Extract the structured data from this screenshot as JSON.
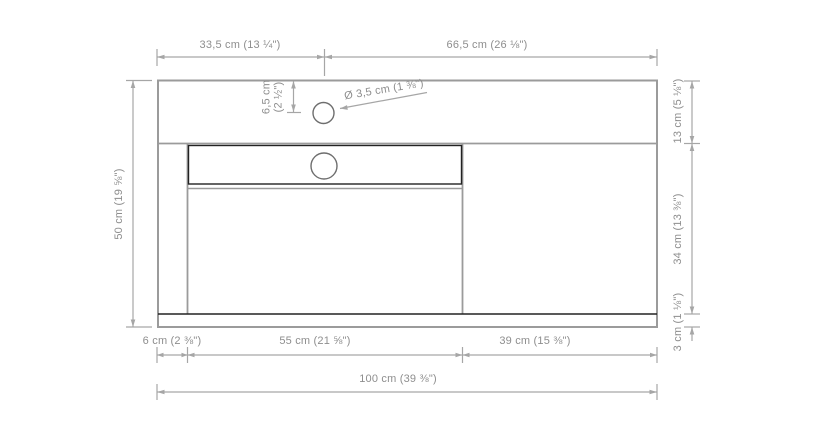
{
  "drawing": {
    "title": "washbasin-countertop-dimension-drawing",
    "colors": {
      "outline_gray": "#9b9b9b",
      "dark_line": "#222222",
      "dimension_gray": "#a6a6a6",
      "text_gray": "#8e8e8e"
    },
    "dimensions": {
      "top_left_width": "33,5 cm (13 ¼\")",
      "top_right_width": "66,5 cm (26 ⅛\")",
      "left_depth": "50 cm (19 ⅝\")",
      "right_top": "13 cm (5 ⅛\")",
      "right_middle": "34 cm (13 ⅜\")",
      "right_bottom": "3 cm (1 ⅛\")",
      "bottom_left": "6 cm (2 ⅜\")",
      "bottom_middle": "55 cm (21 ⅝\")",
      "bottom_right": "39 cm (15 ⅜\")",
      "bottom_total": "100 cm (39 ⅜\")",
      "hole_offset_line1": "6,5 cm",
      "hole_offset_line2": "(2 ½\")",
      "hole_diameter": "Ø 3,5 cm (1 ⅜\")"
    }
  }
}
